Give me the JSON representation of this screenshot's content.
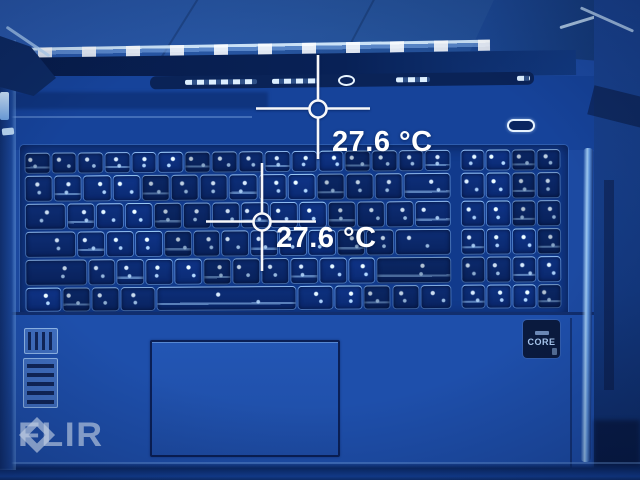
{
  "overlay": {
    "spot1_label": "27.6 °C",
    "spot2_label": "27.6 °C",
    "watermark_text": "FLIR"
  },
  "scene": {
    "description": "thermal image of laptop keyboard",
    "cpu_badge_text": "CORE"
  },
  "colors": {
    "thermal_base": "#1c4aa2",
    "thermal_dark": "#071c4a",
    "thermal_highlight": "#dcefff",
    "overlay_text": "#ffffff",
    "watermark": "#c4d0e4"
  }
}
